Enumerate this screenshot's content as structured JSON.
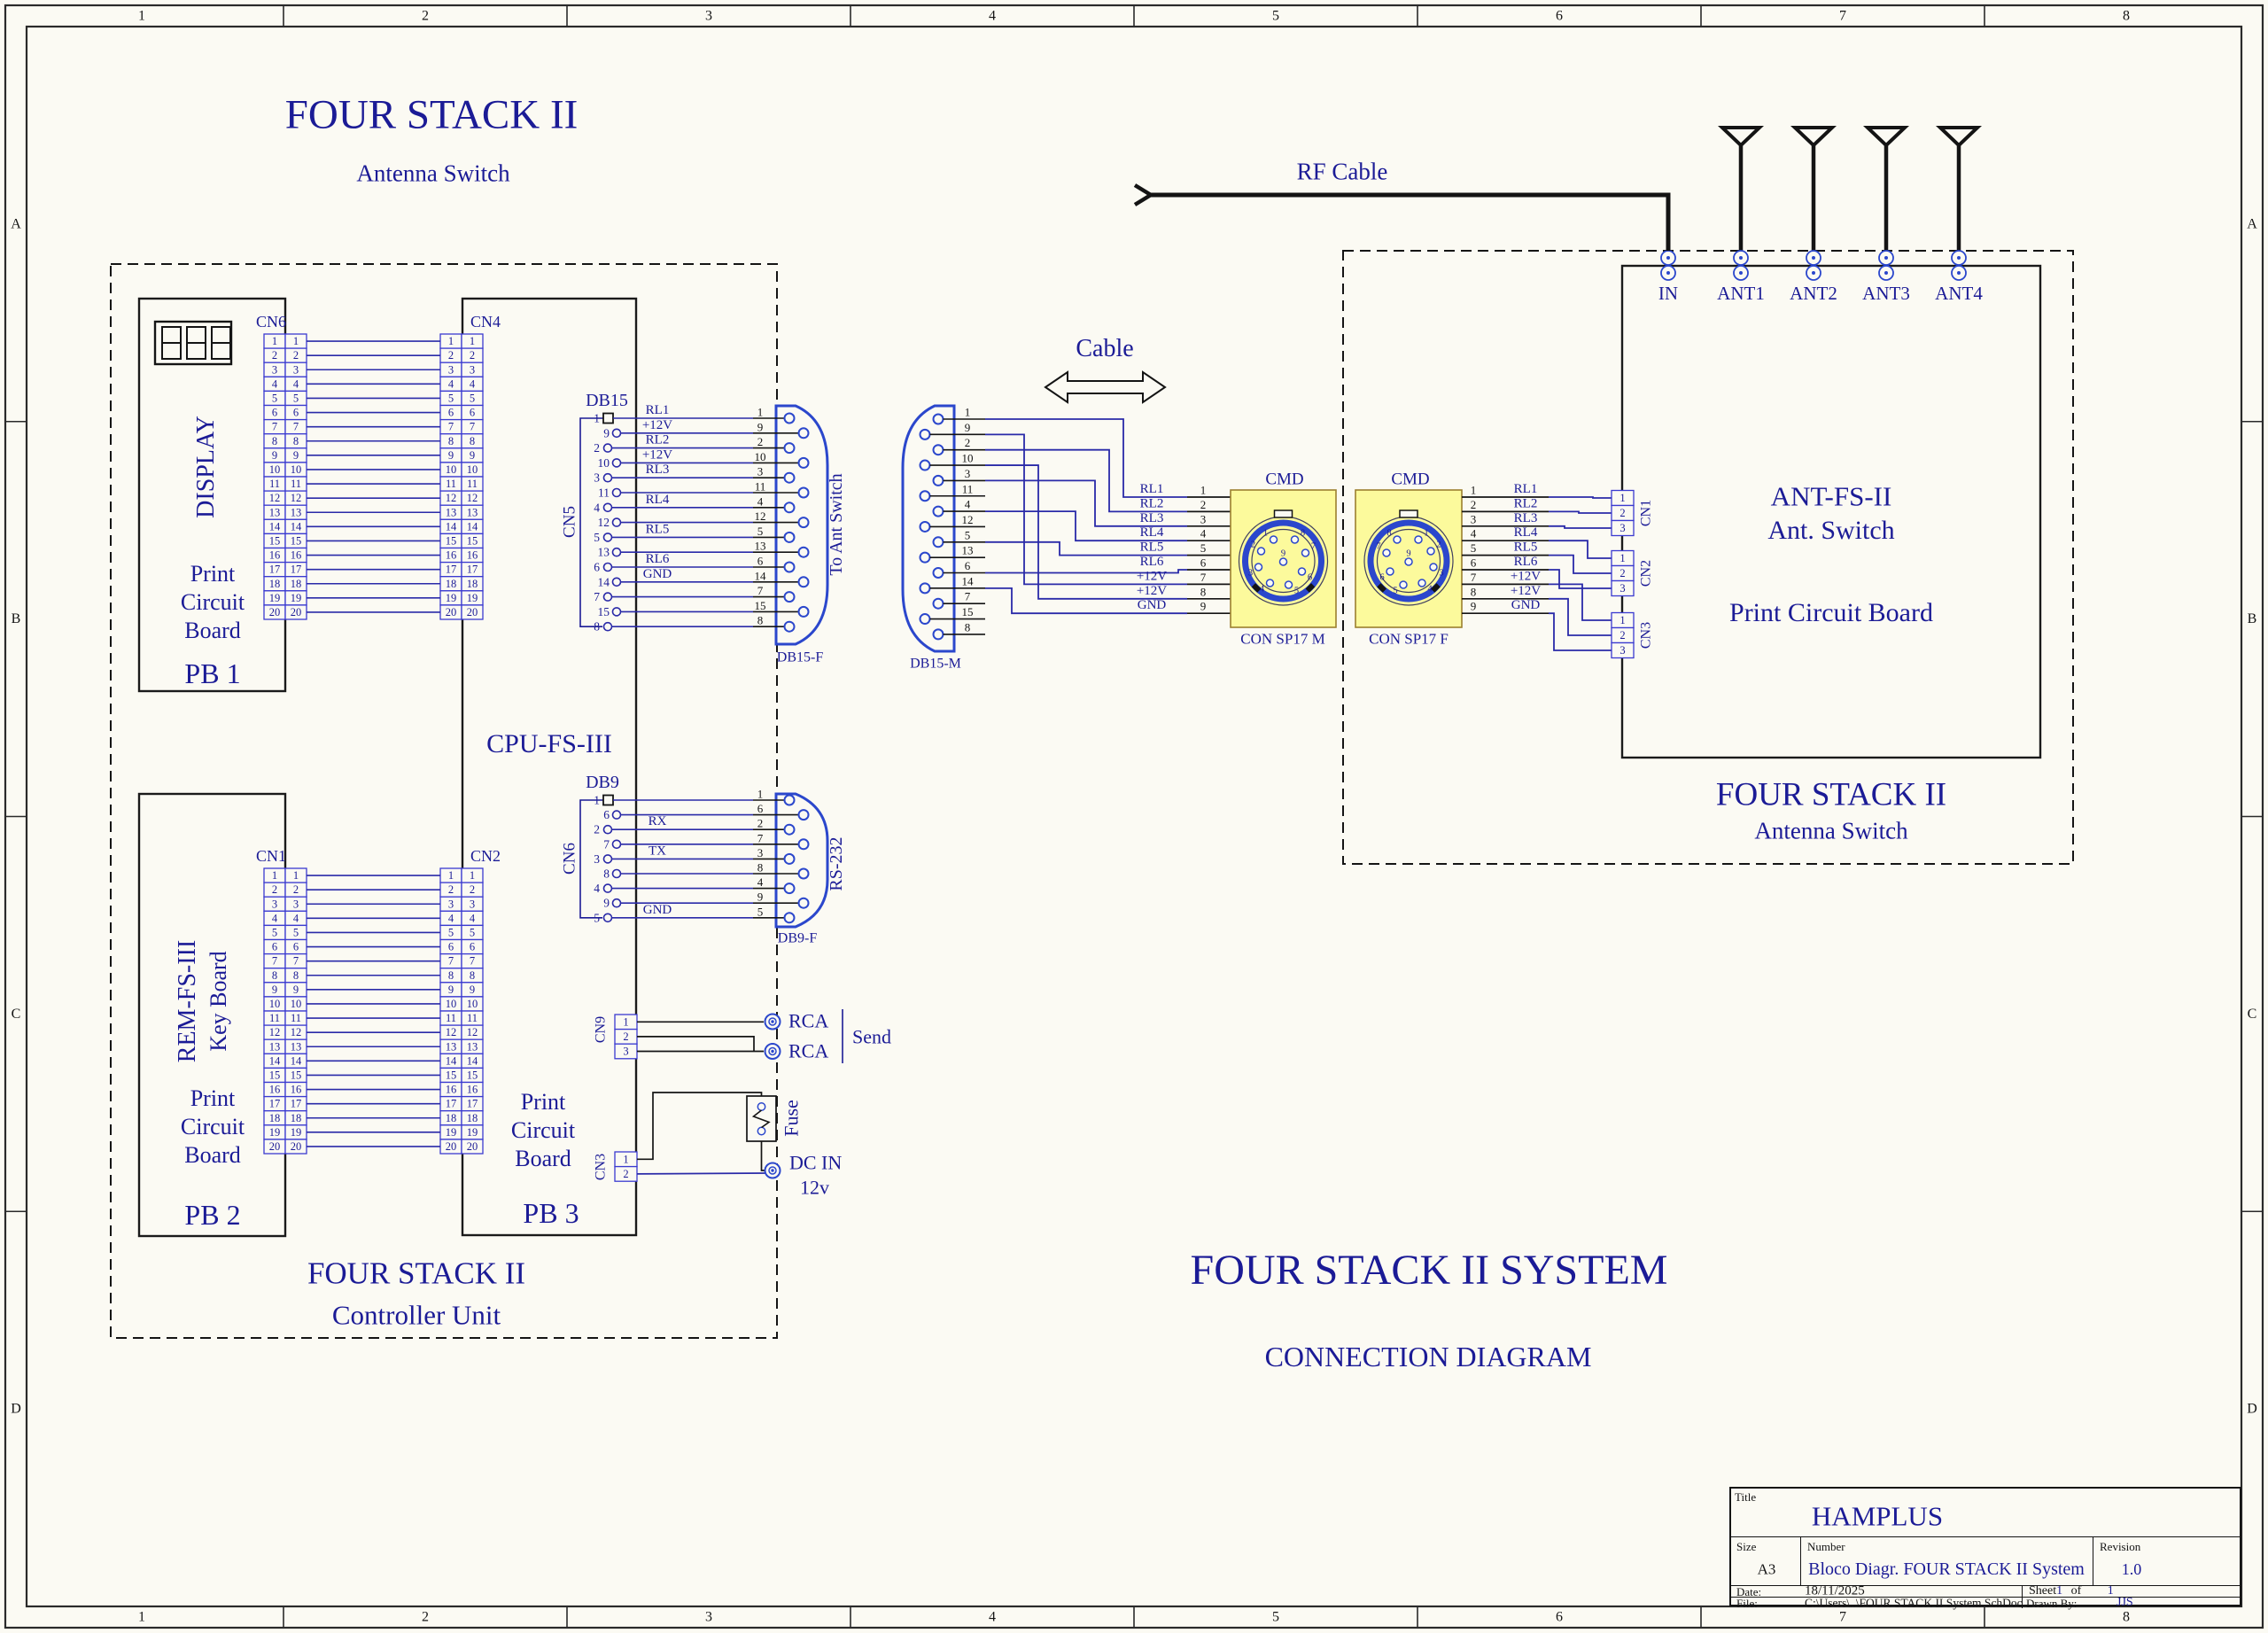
{
  "sheet": {
    "columns": [
      "1",
      "2",
      "3",
      "4",
      "5",
      "6",
      "7",
      "8"
    ],
    "rows": [
      "A",
      "B",
      "C",
      "D"
    ]
  },
  "titles": {
    "left_title": "FOUR STACK II",
    "left_subtitle": "Antenna Switch",
    "controller_caption1": "FOUR STACK II",
    "controller_caption2": "Controller Unit",
    "system_title": "FOUR STACK II SYSTEM",
    "system_subtitle": "CONNECTION DIAGRAM",
    "cable_label": "Cable",
    "rf_cable_label": "RF Cable",
    "right_box_title": "ANT-FS-II",
    "right_box_subtitle": "Ant. Switch",
    "right_box_pcb": "Print Circuit Board",
    "right_caption1": "FOUR STACK II",
    "right_caption2": "Antenna Switch"
  },
  "boards": {
    "pb1": {
      "rotated": "DISPLAY",
      "line1": "Print",
      "line2": "Circuit",
      "line3": "Board",
      "name": "PB 1"
    },
    "pb2": {
      "rotated1": "REM-FS-III",
      "rotated2": "Key Board",
      "line1": "Print",
      "line2": "Circuit",
      "line3": "Board",
      "name": "PB 2"
    },
    "pb3": {
      "cpu": "CPU-FS-III",
      "line1": "Print",
      "line2": "Circuit",
      "line3": "Board",
      "name": "PB 3"
    }
  },
  "ribbons": [
    {
      "left_label": "CN6",
      "right_label": "CN4",
      "pins": 20
    },
    {
      "left_label": "CN1",
      "right_label": "CN2",
      "pins": 20
    }
  ],
  "db15": {
    "title": "DB15",
    "cn_label": "CN5",
    "pin_order": [
      "1",
      "9",
      "2",
      "10",
      "3",
      "11",
      "4",
      "12",
      "5",
      "13",
      "6",
      "14",
      "7",
      "15",
      "8"
    ],
    "row_signals": {
      "0": "RL1",
      "1": "+12V",
      "2": "RL2",
      "3": "+12V",
      "4": "RL3",
      "6": "RL4",
      "8": "RL5",
      "10": "RL6",
      "11": "GND"
    },
    "shell_label": "DB15-F",
    "shell_note": "To Ant Switch"
  },
  "db9": {
    "title": "DB9",
    "cn_label": "CN6",
    "pin_order": [
      "1",
      "6",
      "2",
      "7",
      "3",
      "8",
      "4",
      "9",
      "5"
    ],
    "row_signals": {
      "2": "RX",
      "4": "TX",
      "8": "GND"
    },
    "shell_label": "DB9-F",
    "shell_note": "RS-232"
  },
  "cn9": {
    "label": "CN9",
    "pins": [
      "1",
      "2",
      "3"
    ],
    "jack1": "RCA",
    "jack2": "RCA",
    "send": "Send"
  },
  "cn3": {
    "label": "CN3",
    "pins": [
      "1",
      "2"
    ],
    "fuse": "Fuse",
    "dc1": "DC IN",
    "dc2": "12v"
  },
  "cable": {
    "db15m_label": "DB15-M",
    "db15m_pin_order": [
      "1",
      "9",
      "2",
      "10",
      "3",
      "11",
      "4",
      "12",
      "5",
      "13",
      "6",
      "14",
      "7",
      "15",
      "8"
    ],
    "signals": [
      "RL1",
      "RL2",
      "RL3",
      "RL4",
      "RL5",
      "RL6",
      "+12V",
      "+12V",
      "GND"
    ],
    "signal_pins": [
      "1",
      "2",
      "3",
      "4",
      "5",
      "6",
      "7",
      "8",
      "9"
    ],
    "m_row_map": [
      [
        0,
        0
      ],
      [
        2,
        1
      ],
      [
        4,
        2
      ],
      [
        6,
        3
      ],
      [
        8,
        4
      ],
      [
        10,
        5
      ],
      [
        1,
        6
      ],
      [
        3,
        7
      ],
      [
        11,
        8
      ]
    ],
    "m_connector": {
      "top": "CMD",
      "bottom": "CON SP17 M"
    },
    "f_connector": {
      "top": "CMD",
      "bottom": "CON SP17 F"
    },
    "sp17_pins": [
      "1",
      "2",
      "3",
      "4",
      "5",
      "6",
      "7",
      "8",
      "9"
    ]
  },
  "ant_switch": {
    "terminals": [
      "IN",
      "ANT1",
      "ANT2",
      "ANT3",
      "ANT4"
    ],
    "cn_groups": [
      {
        "label": "CN1",
        "pins": [
          "1",
          "2",
          "3"
        ]
      },
      {
        "label": "CN2",
        "pins": [
          "1",
          "2",
          "3"
        ]
      },
      {
        "label": "CN3",
        "pins": [
          "1",
          "2",
          "3"
        ]
      }
    ]
  },
  "title_block": {
    "title_label": "Title",
    "company": "HAMPLUS",
    "size_label": "Size",
    "size": "A3",
    "number_label": "Number",
    "number": "Bloco Diagr. FOUR STACK II System",
    "revision_label": "Revision",
    "revision": "1.0",
    "date_label": "Date:",
    "date": "18/11/2025",
    "sheet_label": "Sheet",
    "sheet_num": "1",
    "of_label": "of",
    "sheet_total": "1",
    "file_label": "File:",
    "file": "C:\\Users\\..\\FOUR STACK II System.SchDoc",
    "drawn_label": "Drawn By:",
    "drawn_by": "JJS"
  },
  "colors": {
    "navy": "#1b1b96",
    "wire": "#2a2aa8",
    "cell": "#3a3ad0",
    "shell": "#2b47cc",
    "black": "#141414",
    "bg": "#fbfaf3",
    "yellow": "#fcfa9c",
    "yellow_border": "#9c8030"
  }
}
